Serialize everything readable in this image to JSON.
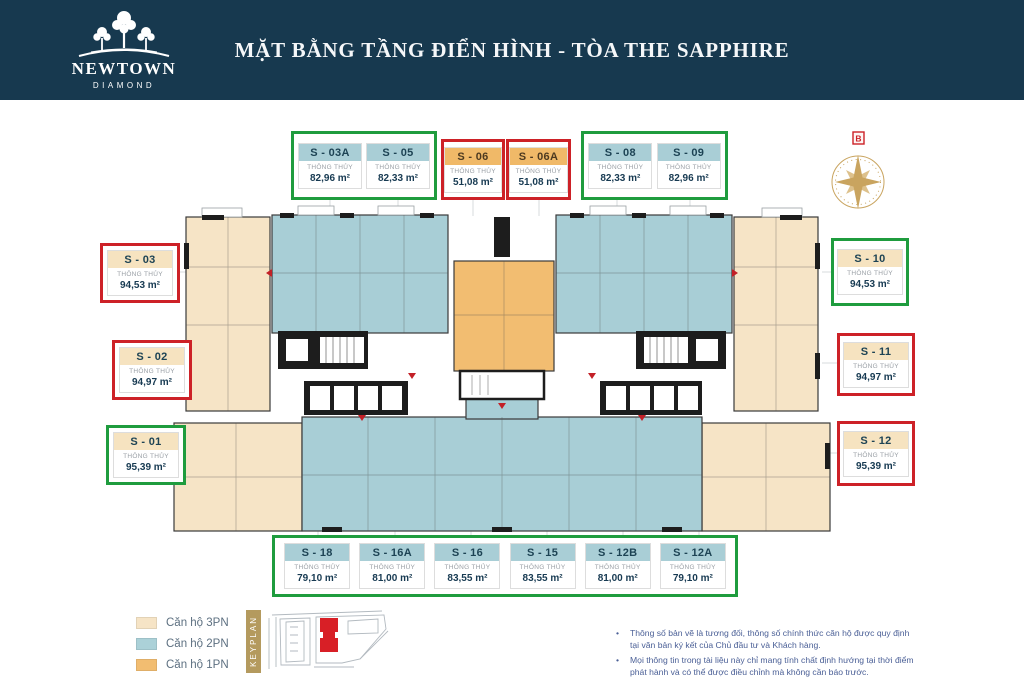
{
  "header": {
    "title": "MẶT BẰNG TẦNG ĐIỂN HÌNH - TÒA THE SAPPHIRE",
    "logo_name": "NEWTOWN",
    "logo_sub": "DIAMOND"
  },
  "compass": {
    "north_label": "B"
  },
  "spec_label": "THÔNG THỦY",
  "unit_groups": {
    "top": [
      {
        "frame": "green",
        "units": [
          {
            "id": "S - 03A",
            "area": "82,96 m²",
            "type": "2PN"
          },
          {
            "id": "S - 05",
            "area": "82,33 m²",
            "type": "2PN"
          }
        ]
      },
      {
        "frame": "red",
        "units": [
          {
            "id": "S - 06",
            "area": "51,08 m²",
            "type": "1PN"
          }
        ]
      },
      {
        "frame": "red",
        "units": [
          {
            "id": "S - 06A",
            "area": "51,08 m²",
            "type": "1PN"
          }
        ]
      },
      {
        "frame": "green",
        "units": [
          {
            "id": "S - 08",
            "area": "82,33 m²",
            "type": "2PN"
          },
          {
            "id": "S - 09",
            "area": "82,96 m²",
            "type": "2PN"
          }
        ]
      }
    ],
    "left": [
      {
        "frame": "red",
        "units": [
          {
            "id": "S - 03",
            "area": "94,53 m²",
            "type": "3PN"
          }
        ]
      },
      {
        "frame": "red",
        "units": [
          {
            "id": "S - 02",
            "area": "94,97 m²",
            "type": "3PN"
          }
        ]
      },
      {
        "frame": "green",
        "units": [
          {
            "id": "S - 01",
            "area": "95,39 m²",
            "type": "3PN"
          }
        ]
      }
    ],
    "right": [
      {
        "frame": "green",
        "units": [
          {
            "id": "S - 10",
            "area": "94,53 m²",
            "type": "3PN"
          }
        ]
      },
      {
        "frame": "red",
        "units": [
          {
            "id": "S - 11",
            "area": "94,97 m²",
            "type": "3PN"
          }
        ]
      },
      {
        "frame": "red",
        "units": [
          {
            "id": "S - 12",
            "area": "95,39 m²",
            "type": "3PN"
          }
        ]
      }
    ],
    "bottom": [
      {
        "frame": "green",
        "units": [
          {
            "id": "S - 18",
            "area": "79,10 m²",
            "type": "2PN"
          },
          {
            "id": "S - 16A",
            "area": "81,00 m²",
            "type": "2PN"
          },
          {
            "id": "S - 16",
            "area": "83,55 m²",
            "type": "2PN"
          },
          {
            "id": "S - 15",
            "area": "83,55 m²",
            "type": "2PN"
          },
          {
            "id": "S - 12B",
            "area": "81,00 m²",
            "type": "2PN"
          },
          {
            "id": "S - 12A",
            "area": "79,10 m²",
            "type": "2PN"
          }
        ]
      }
    ]
  },
  "legend": {
    "items": [
      {
        "label": "Căn hộ 3PN",
        "color": "#f6e4c6"
      },
      {
        "label": "Căn hộ 2PN",
        "color": "#abd1d8"
      },
      {
        "label": "Căn hộ 1PN",
        "color": "#f2bd71"
      }
    ],
    "keyplan_label": "KEYPLAN"
  },
  "notes": {
    "items": [
      "Thông số bản vẽ là tương đối, thông số chính thức căn hộ được quy định tại văn bản ký kết của Chủ đầu tư và Khách hàng.",
      "Mọi thông tin trong tài liệu này chỉ mang tính chất định hướng tại thời điểm phát hành và có thể được điều chỉnh mà không cần báo trước."
    ]
  },
  "colors": {
    "header_navy": "#17394f",
    "frame_green": "#1f9c3e",
    "frame_red": "#cd2127",
    "unit_2pn_blue": "#a8ced6",
    "unit_3pn_beige": "#f6e4c6",
    "unit_1pn_orange": "#f2bd71",
    "compass_gold": "#c9a45f",
    "keyplan_tan": "#b49a5e",
    "note_blue": "#4a5f96"
  }
}
